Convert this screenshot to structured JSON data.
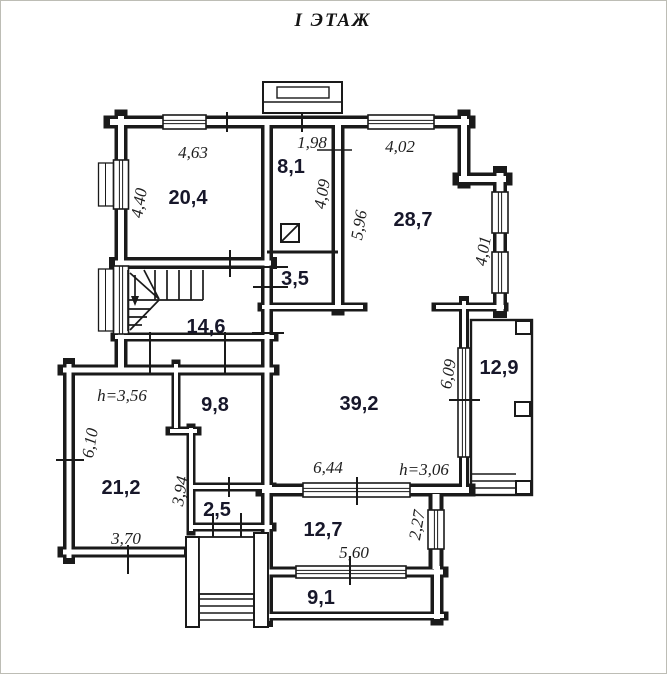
{
  "title": "I ЭТАЖ",
  "plan": {
    "rooms": [
      {
        "label": "20,4"
      },
      {
        "label": "8,1"
      },
      {
        "label": "28,7"
      },
      {
        "label": "3,5"
      },
      {
        "label": "14,6"
      },
      {
        "label": "9,8"
      },
      {
        "label": "39,2"
      },
      {
        "label": "12,9"
      },
      {
        "label": "21,2"
      },
      {
        "label": "2,5"
      },
      {
        "label": "12,7"
      },
      {
        "label": "9,1"
      }
    ],
    "dimensions": [
      {
        "label": "4,63"
      },
      {
        "label": "1,98"
      },
      {
        "label": "4,02"
      },
      {
        "label": "4,40"
      },
      {
        "label": "4,09"
      },
      {
        "label": "5,96"
      },
      {
        "label": "4,01"
      },
      {
        "label": "6,09"
      },
      {
        "label": "h=3,56"
      },
      {
        "label": "6,10"
      },
      {
        "label": "3,94"
      },
      {
        "label": "6,44"
      },
      {
        "label": "h=3,06"
      },
      {
        "label": "2,27"
      },
      {
        "label": "3,70"
      },
      {
        "label": "5,60"
      }
    ],
    "colors": {
      "ink": "#1a1a1a",
      "room_label_ink": "#17172a",
      "paper": "#ffffff"
    }
  }
}
